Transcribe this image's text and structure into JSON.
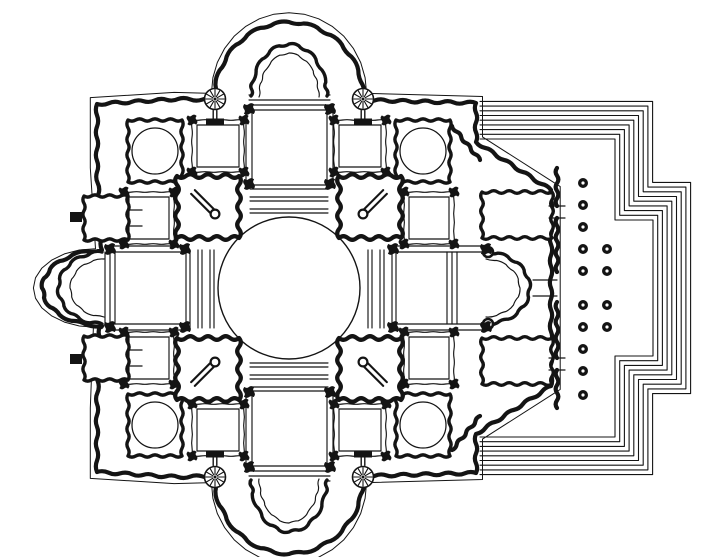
{
  "figure": {
    "kind": "architectural-floor-plan",
    "subject": "centralized-church-plan-with-east-portico"
  },
  "style": {
    "paper": "#ffffff",
    "ink": "#141414",
    "thin": 1.15,
    "wall": 4.2,
    "mid": 3.4
  },
  "canvas": {
    "width": 720,
    "height": 557
  },
  "wall_outline": [
    {
      "type": "pts",
      "points": [
        [
          97,
          172
        ],
        [
          97,
          104
        ],
        [
          178,
          99
        ]
      ]
    },
    {
      "type": "arc",
      "cx": 289,
      "cy": 100,
      "rx": 75,
      "ry": 78,
      "a0": 180,
      "a1": 360,
      "n": 16
    },
    {
      "type": "pts",
      "points": [
        [
          476,
          103
        ],
        [
          476,
          142
        ],
        [
          551,
          190
        ],
        [
          551,
          386
        ],
        [
          476,
          434
        ],
        [
          476,
          473
        ],
        [
          364,
          476
        ]
      ]
    },
    {
      "type": "arc",
      "cx": 289,
      "cy": 476,
      "rx": 75,
      "ry": 78,
      "a0": 0,
      "a1": 180,
      "n": 16
    },
    {
      "type": "pts",
      "points": [
        [
          178,
          477
        ],
        [
          97,
          472
        ],
        [
          97,
          404
        ],
        [
          100,
          326
        ]
      ]
    },
    {
      "type": "arc",
      "cx": 102,
      "cy": 288,
      "rx": 60,
      "ry": 38,
      "a0": 90,
      "a1": 270,
      "n": 12
    }
  ],
  "dome": {
    "cx": 289,
    "cy": 288,
    "r": 71
  },
  "crossing_bars": {
    "north_ys": [
      185,
      197,
      209
    ],
    "south_ys": [
      363,
      375,
      387
    ],
    "west_xs": [
      186,
      198,
      210
    ],
    "east_xs": [
      368,
      380,
      392
    ],
    "span_a": 250,
    "span_b": 328,
    "pair_gap": 4
  },
  "chapels": [
    {
      "x": 128,
      "y": 120,
      "w": 54,
      "h": 62,
      "circle": {
        "cx": 155,
        "cy": 151,
        "r": 23
      }
    },
    {
      "x": 396,
      "y": 120,
      "w": 54,
      "h": 62,
      "circle": {
        "cx": 423,
        "cy": 151,
        "r": 23
      }
    },
    {
      "x": 128,
      "y": 394,
      "w": 54,
      "h": 62,
      "circle": {
        "cx": 155,
        "cy": 425,
        "r": 23
      }
    },
    {
      "x": 396,
      "y": 394,
      "w": 54,
      "h": 62,
      "circle": {
        "cx": 423,
        "cy": 425,
        "r": 23
      }
    }
  ],
  "bays": [
    {
      "x": 192,
      "y": 120,
      "w": 52,
      "h": 52
    },
    {
      "x": 334,
      "y": 120,
      "w": 52,
      "h": 52
    },
    {
      "x": 192,
      "y": 404,
      "w": 52,
      "h": 52
    },
    {
      "x": 334,
      "y": 404,
      "w": 52,
      "h": 52
    },
    {
      "x": 124,
      "y": 192,
      "w": 50,
      "h": 52
    },
    {
      "x": 404,
      "y": 192,
      "w": 50,
      "h": 52
    },
    {
      "x": 124,
      "y": 332,
      "w": 50,
      "h": 52
    },
    {
      "x": 404,
      "y": 332,
      "w": 50,
      "h": 52
    }
  ],
  "east_rooms": [
    {
      "x": 482,
      "y": 192,
      "w": 70,
      "h": 46
    },
    {
      "x": 482,
      "y": 338,
      "w": 70,
      "h": 46
    }
  ],
  "piers": [
    {
      "x": 177,
      "y": 176,
      "w": 62,
      "h": 62
    },
    {
      "x": 339,
      "y": 176,
      "w": 62,
      "h": 62
    },
    {
      "x": 177,
      "y": 338,
      "w": 62,
      "h": 62
    },
    {
      "x": 339,
      "y": 338,
      "w": 62,
      "h": 62
    }
  ],
  "stair_bars": [
    {
      "x1": 193,
      "y1": 192,
      "x2": 215,
      "y2": 214
    },
    {
      "x1": 385,
      "y1": 192,
      "x2": 363,
      "y2": 214
    },
    {
      "x1": 193,
      "y1": 384,
      "x2": 215,
      "y2": 362
    },
    {
      "x1": 385,
      "y1": 384,
      "x2": 363,
      "y2": 362
    }
  ],
  "arms": {
    "top": {
      "wall_xs": [
        246,
        252,
        327,
        333
      ],
      "wall_y1": 112,
      "wall_y2": 183,
      "lines_ys": [
        95,
        100,
        105,
        110
      ],
      "lines_x1": 249,
      "lines_x2": 330,
      "apse": {
        "cx": 289,
        "cy": 96,
        "rx": 38,
        "ry": 52,
        "a0": 180,
        "a1": 360,
        "n": 12
      },
      "inner_apse": {
        "cx": 289,
        "cy": 97,
        "rx": 30,
        "ry": 44,
        "a0": 180,
        "a1": 360,
        "n": 10
      }
    },
    "bottom": {
      "wall_xs": [
        246,
        252,
        327,
        333
      ],
      "wall_y1": 393,
      "wall_y2": 464,
      "lines_ys": [
        466,
        471,
        476,
        481
      ],
      "lines_x1": 249,
      "lines_x2": 330,
      "apse": {
        "cx": 289,
        "cy": 480,
        "rx": 38,
        "ry": 52,
        "a0": 0,
        "a1": 180,
        "n": 12
      },
      "inner_apse": {
        "cx": 289,
        "cy": 479,
        "rx": 30,
        "ry": 44,
        "a0": 0,
        "a1": 180,
        "n": 10
      }
    },
    "west": {
      "wall_ys": [
        246,
        252,
        324,
        330
      ],
      "wall_x1": 112,
      "wall_x2": 183,
      "lines_xs": [
        100,
        105,
        110,
        115
      ],
      "lines_y1": 252,
      "lines_y2": 324,
      "apse": {
        "cx": 102,
        "cy": 288,
        "rx": 44,
        "ry": 36,
        "a0": 90,
        "a1": 270,
        "n": 12
      },
      "inner_apse": {
        "cx": 104,
        "cy": 288,
        "rx": 34,
        "ry": 29,
        "a0": 90,
        "a1": 270,
        "n": 10
      }
    },
    "east": {
      "wall_ys": [
        246,
        252,
        324,
        330
      ],
      "wall_x1": 395,
      "wall_x2": 486,
      "lines_xs": [
        447,
        452,
        457
      ],
      "lines_y1": 252,
      "lines_y2": 324,
      "apse": {
        "cx": 486,
        "cy": 288,
        "rx": 44,
        "ry": 36,
        "a0": -90,
        "a1": 90,
        "n": 12
      },
      "inner_apse": {
        "cx": 486,
        "cy": 288,
        "rx": 34,
        "ry": 29,
        "a0": -90,
        "a1": 90,
        "n": 10
      },
      "knobs": [
        [
          488,
          252
        ],
        [
          488,
          324
        ]
      ]
    }
  },
  "rosettes": [
    {
      "cx": 215,
      "cy": 99,
      "r": 10.5,
      "spokes": 12,
      "dir": 1
    },
    {
      "cx": 363,
      "cy": 99,
      "r": 10.5,
      "spokes": 12,
      "dir": 1
    },
    {
      "cx": 215,
      "cy": 477,
      "r": 10.5,
      "spokes": 12,
      "dir": -1
    },
    {
      "cx": 363,
      "cy": 477,
      "r": 10.5,
      "spokes": 12,
      "dir": -1
    }
  ],
  "west_chapels": {
    "squares": [
      {
        "x": 84,
        "y": 196,
        "w": 44,
        "h": 44
      },
      {
        "x": 84,
        "y": 336,
        "w": 44,
        "h": 44
      }
    ],
    "stubs": [
      {
        "x": 70,
        "y": 212,
        "w": 12,
        "h": 10
      },
      {
        "x": 70,
        "y": 354,
        "w": 12,
        "h": 10
      }
    ],
    "neck_lines": [
      [
        128,
        210,
        142,
        210
      ],
      [
        128,
        226,
        142,
        226
      ],
      [
        128,
        350,
        142,
        350
      ],
      [
        128,
        366,
        142,
        366
      ]
    ]
  },
  "east_wall": {
    "x": 557,
    "segments": [
      [
        168,
        206
      ],
      [
        218,
        272
      ],
      [
        302,
        358
      ],
      [
        370,
        408
      ]
    ],
    "door_lines": [
      [
        533,
        280,
        557,
        280
      ],
      [
        533,
        296,
        557,
        296
      ],
      [
        549,
        206,
        565,
        206
      ],
      [
        549,
        218,
        565,
        218
      ],
      [
        549,
        358,
        565,
        358
      ],
      [
        549,
        370,
        565,
        370
      ]
    ],
    "diagonals": [
      [
        452,
        126,
        480,
        160
      ],
      [
        452,
        450,
        480,
        416
      ]
    ]
  },
  "colonnade": {
    "dot_r": 5.0,
    "hole_r": 1.6,
    "rows": [
      {
        "x": 583,
        "ys": [
          183,
          205,
          227,
          249,
          271,
          305,
          327,
          349,
          371,
          395
        ]
      },
      {
        "x": 607,
        "ys": [
          249,
          271,
          305,
          327
        ]
      }
    ]
  },
  "steps": {
    "count": 9,
    "spacing": 4.7,
    "x_start": 480,
    "top_y_inner": 139,
    "turn_x_inner": 615,
    "turn_y_inner": 220,
    "right_x_inner": 653,
    "mirror_turn_y_inner": 356,
    "bottom_y_inner": 437
  },
  "nodes_extra": [
    [
      249,
      184
    ],
    [
      330,
      184
    ],
    [
      249,
      109
    ],
    [
      330,
      109
    ],
    [
      249,
      392
    ],
    [
      330,
      392
    ],
    [
      249,
      467
    ],
    [
      330,
      467
    ],
    [
      185,
      249
    ],
    [
      185,
      327
    ],
    [
      110,
      249
    ],
    [
      110,
      327
    ],
    [
      393,
      249
    ],
    [
      393,
      327
    ],
    [
      486,
      249
    ],
    [
      486,
      327
    ]
  ]
}
